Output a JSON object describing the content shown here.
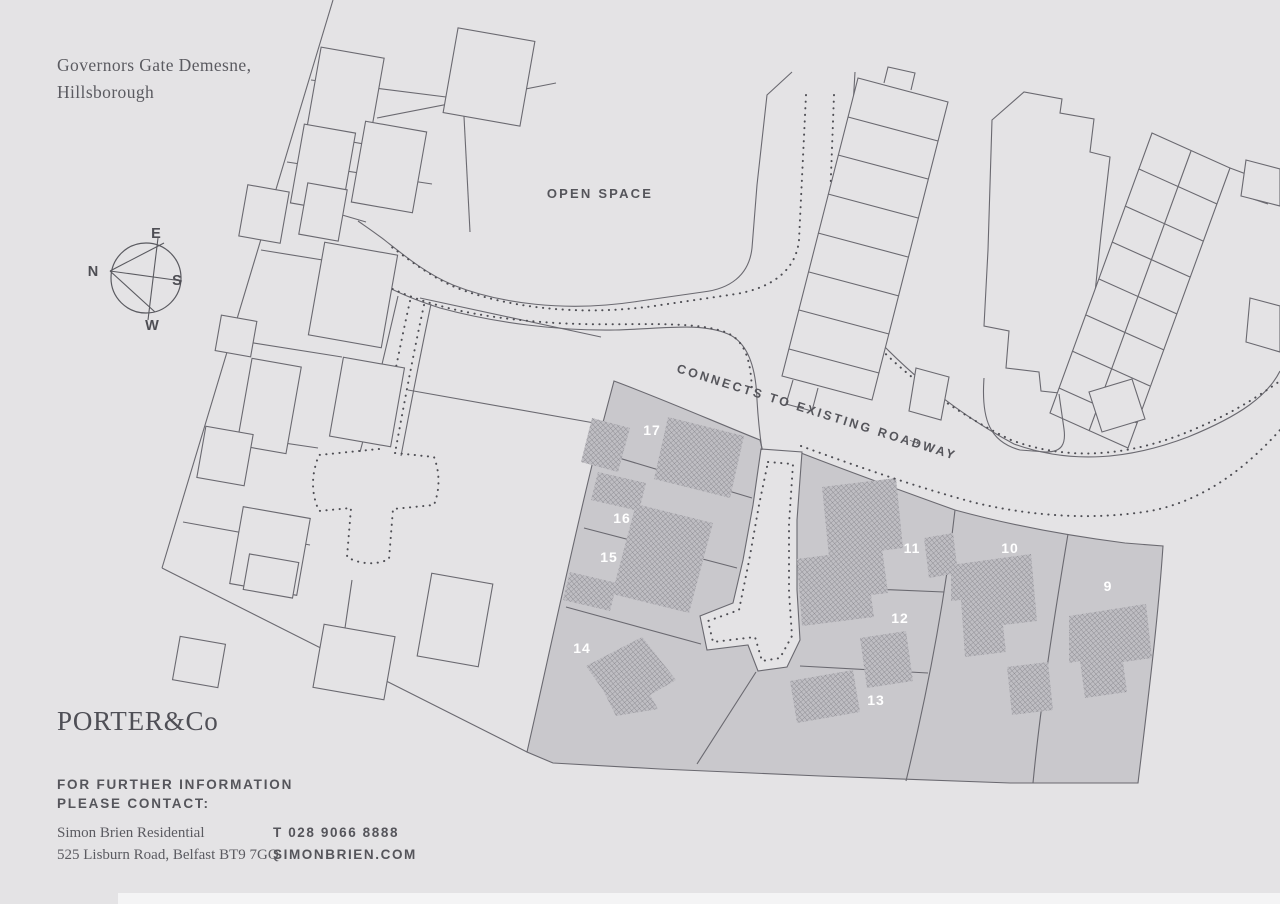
{
  "title": {
    "line1": "Governors Gate Demesne,",
    "line2": "Hillsborough"
  },
  "compass": {
    "north": "N",
    "east": "E",
    "south": "S",
    "west": "W"
  },
  "map_labels": {
    "open_space": "OPEN SPACE",
    "roadway": "CONNECTS TO EXISTING ROADWAY",
    "roadway_arrow": "→"
  },
  "plots": [
    {
      "number": "17"
    },
    {
      "number": "16"
    },
    {
      "number": "15"
    },
    {
      "number": "14"
    },
    {
      "number": "13"
    },
    {
      "number": "12"
    },
    {
      "number": "11"
    },
    {
      "number": "10"
    },
    {
      "number": "9"
    }
  ],
  "footer": {
    "brand": "PORTER&Co",
    "info_line1": "FOR FURTHER INFORMATION",
    "info_line2": "PLEASE CONTACT:",
    "agent_name": "Simon Brien Residential",
    "agent_address": "525 Lisburn Road, Belfast BT9 7GQ",
    "phone": "T 028 9066 8888",
    "website": "SIMONBRIEN.COM"
  },
  "colors": {
    "background": "#e4e3e5",
    "plot_fill": "#c9c8cc",
    "line": "#6a6970",
    "dotted": "#4e4e54",
    "plot_number": "#ffffff",
    "text": "#55555b"
  }
}
